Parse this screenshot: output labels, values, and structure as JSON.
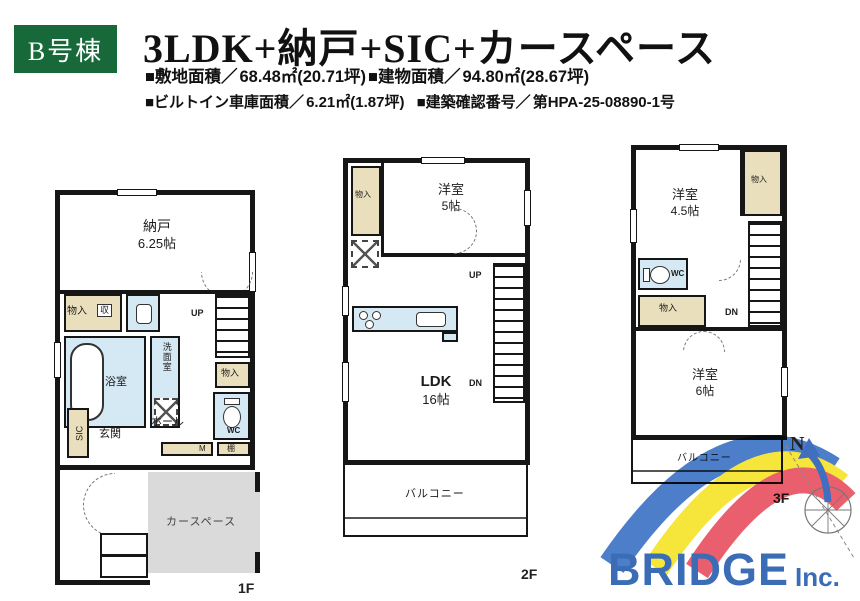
{
  "header": {
    "unit_label": "B号棟",
    "title": "3LDK+納戸+SIC+カースペース",
    "specs": {
      "site_area_label": "■敷地面積／",
      "site_area_value": "68.48㎡(20.71坪)",
      "building_area_label": "■建物面積／",
      "building_area_value": "94.80㎡(28.67坪)",
      "garage_label": "■ビルトイン車庫面積／",
      "garage_value": "6.21㎡(1.87坪)",
      "confirm_label": "■建築確認番号／",
      "confirm_value": "第HPA-25-08890-1号"
    }
  },
  "floor1": {
    "label": "1F",
    "nando_name": "納戸",
    "nando_size": "6.25帖",
    "closet1": "物入",
    "shuno": "収",
    "bath": "浴室",
    "senmen": "洗面室",
    "up": "UP",
    "closet2": "物入",
    "sic": "SIC",
    "genkan": "玄関",
    "hall": "ホール",
    "wc": "WC",
    "meter": "M",
    "tana": "棚",
    "car_space": "カースペース"
  },
  "floor2": {
    "label": "2F",
    "closet": "物入",
    "yoshitsu_name": "洋室",
    "yoshitsu_size": "5帖",
    "up": "UP",
    "dn": "DN",
    "ldk_name": "LDK",
    "ldk_size": "16帖",
    "balcony": "バルコニー"
  },
  "floor3": {
    "label": "3F",
    "yoshitsu45_name": "洋室",
    "yoshitsu45_size": "4.5帖",
    "closet1": "物入",
    "wc": "WC",
    "closet2": "物入",
    "dn": "DN",
    "yoshitsu6_name": "洋室",
    "yoshitsu6_size": "6帖",
    "balcony": "バルコニー"
  },
  "logo": {
    "brand": "BRIDGE",
    "suffix": "Inc."
  },
  "compass": {
    "north_label": "N"
  },
  "colors": {
    "accent_green": "#17693a",
    "logo_blue": "#3b6db6",
    "arc_blue": "#4d7ec9",
    "arc_yellow": "#f6e53a",
    "arc_red": "#ea5f6e",
    "closet_beige": "#eadfbc",
    "water_blue": "#d4e9f4",
    "car_gray": "#dadada",
    "wall_black": "#161616"
  }
}
